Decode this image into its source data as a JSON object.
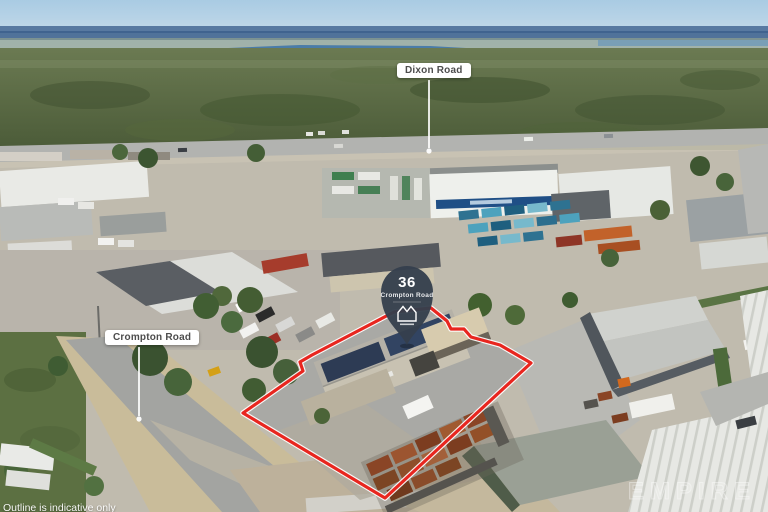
{
  "annotations": {
    "dixon_road_label": "Dixon Road",
    "crompton_road_label": "Crompton Road",
    "pin": {
      "number": "36",
      "street": "Crompton Road",
      "logo_icon": "crown-icon"
    },
    "disclaimer": "Outline is indicative only",
    "watermark": "EMPIRE"
  },
  "colors": {
    "outline_red": "#e8261f",
    "outline_casing": "#ffffff",
    "pin_fill": "#353f4d",
    "label_background": "#ffffff",
    "label_text": "#4d4d4d",
    "disclaimer_text": "#ffffff"
  }
}
